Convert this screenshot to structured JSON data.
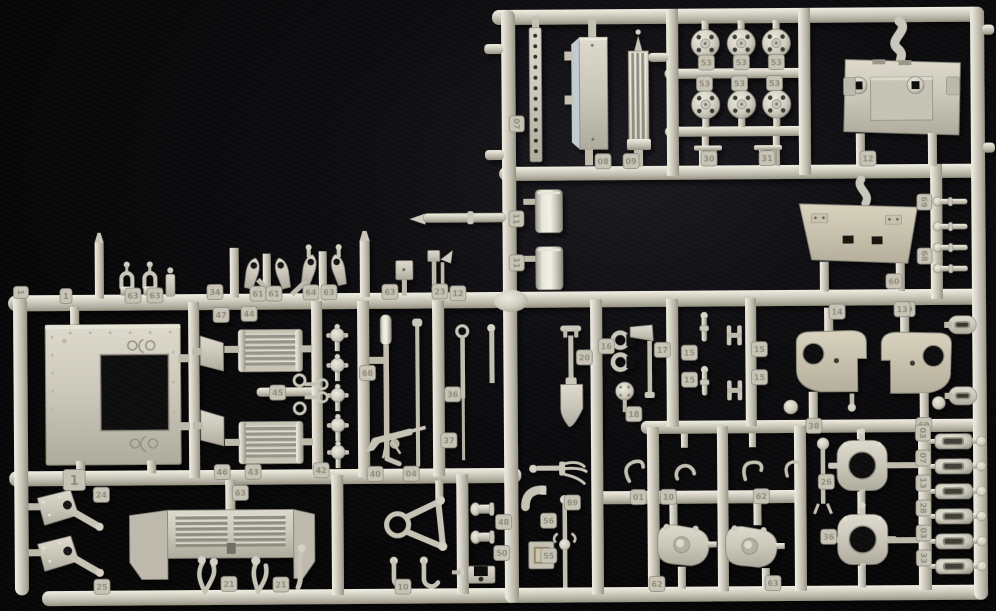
{
  "scene": {
    "description": "Photograph of a light grey injection-moulded plastic model kit sprue (parts tree) for an armoured vehicle kit, lying on a black cloth background",
    "object": "model-kit-sprue",
    "background_color": "#0a0a0c",
    "plastic_color": "#cdcabd",
    "plastic_highlight": "#f1efe4",
    "plastic_shadow": "#8e8c80",
    "tag_plate_color": "#c6c3b5",
    "tag_text_color": "#8f8c7d",
    "tag_edge_color": "#86847a"
  },
  "part_tags": [
    {
      "x": 518,
      "y": 124,
      "label": "07",
      "rot": 90
    },
    {
      "x": 604,
      "y": 162,
      "label": "08"
    },
    {
      "x": 632,
      "y": 162,
      "label": "09"
    },
    {
      "x": 708,
      "y": 64,
      "label": "53"
    },
    {
      "x": 743,
      "y": 64,
      "label": "53"
    },
    {
      "x": 778,
      "y": 64,
      "label": "53"
    },
    {
      "x": 706,
      "y": 85,
      "label": "53"
    },
    {
      "x": 741,
      "y": 85,
      "label": "53"
    },
    {
      "x": 776,
      "y": 85,
      "label": "53"
    },
    {
      "x": 710,
      "y": 160,
      "label": "30"
    },
    {
      "x": 768,
      "y": 160,
      "label": "31"
    },
    {
      "x": 869,
      "y": 161,
      "label": "12"
    },
    {
      "x": 925,
      "y": 205,
      "label": "69",
      "rot": 90
    },
    {
      "x": 925,
      "y": 259,
      "label": "68",
      "rot": 90
    },
    {
      "x": 894,
      "y": 284,
      "label": "60"
    },
    {
      "x": 907,
      "y": 312,
      "label": "19"
    },
    {
      "x": 517,
      "y": 219,
      "label": "11",
      "rot": 90
    },
    {
      "x": 517,
      "y": 263,
      "label": "11",
      "rot": 90
    },
    {
      "x": 440,
      "y": 291,
      "label": "23"
    },
    {
      "x": 458,
      "y": 293,
      "label": "12"
    },
    {
      "x": 21,
      "y": 289,
      "label": "1",
      "rot": 90
    },
    {
      "x": 66,
      "y": 293,
      "label": "1"
    },
    {
      "x": 133,
      "y": 293,
      "label": "63"
    },
    {
      "x": 155,
      "y": 293,
      "label": "63"
    },
    {
      "x": 215,
      "y": 290,
      "label": "34"
    },
    {
      "x": 258,
      "y": 292,
      "label": "61"
    },
    {
      "x": 274,
      "y": 292,
      "label": "61"
    },
    {
      "x": 311,
      "y": 291,
      "label": "64"
    },
    {
      "x": 329,
      "y": 291,
      "label": "63"
    },
    {
      "x": 390,
      "y": 291,
      "label": "63"
    },
    {
      "x": 221,
      "y": 313,
      "label": "47"
    },
    {
      "x": 249,
      "y": 312,
      "label": "44"
    },
    {
      "x": 221,
      "y": 470,
      "label": "46"
    },
    {
      "x": 252,
      "y": 470,
      "label": "43"
    },
    {
      "x": 320,
      "y": 469,
      "label": "42"
    },
    {
      "x": 277,
      "y": 391,
      "label": "45"
    },
    {
      "x": 367,
      "y": 372,
      "label": "68"
    },
    {
      "x": 452,
      "y": 394,
      "label": "36"
    },
    {
      "x": 448,
      "y": 440,
      "label": "37"
    },
    {
      "x": 584,
      "y": 358,
      "label": "20"
    },
    {
      "x": 606,
      "y": 347,
      "label": "16"
    },
    {
      "x": 662,
      "y": 351,
      "label": "17"
    },
    {
      "x": 633,
      "y": 415,
      "label": "18"
    },
    {
      "x": 689,
      "y": 354,
      "label": "15"
    },
    {
      "x": 689,
      "y": 381,
      "label": "15"
    },
    {
      "x": 759,
      "y": 351,
      "label": "15"
    },
    {
      "x": 759,
      "y": 379,
      "label": "15"
    },
    {
      "x": 837,
      "y": 314,
      "label": "14"
    },
    {
      "x": 902,
      "y": 312,
      "label": "13"
    },
    {
      "x": 813,
      "y": 428,
      "label": "38"
    },
    {
      "x": 923,
      "y": 428,
      "label": "60"
    },
    {
      "x": 100,
      "y": 492,
      "label": "24"
    },
    {
      "x": 100,
      "y": 584,
      "label": "25"
    },
    {
      "x": 239,
      "y": 491,
      "label": "63"
    },
    {
      "x": 227,
      "y": 582,
      "label": "21"
    },
    {
      "x": 279,
      "y": 583,
      "label": "21"
    },
    {
      "x": 374,
      "y": 473,
      "label": "40"
    },
    {
      "x": 410,
      "y": 473,
      "label": "04"
    },
    {
      "x": 401,
      "y": 586,
      "label": "10"
    },
    {
      "x": 502,
      "y": 522,
      "label": "48"
    },
    {
      "x": 500,
      "y": 553,
      "label": "50"
    },
    {
      "x": 547,
      "y": 521,
      "label": "56"
    },
    {
      "x": 571,
      "y": 503,
      "label": "89"
    },
    {
      "x": 547,
      "y": 556,
      "label": "55"
    },
    {
      "x": 637,
      "y": 498,
      "label": "01"
    },
    {
      "x": 667,
      "y": 498,
      "label": "10"
    },
    {
      "x": 760,
      "y": 498,
      "label": "62"
    },
    {
      "x": 655,
      "y": 585,
      "label": "62"
    },
    {
      "x": 771,
      "y": 585,
      "label": "63"
    },
    {
      "x": 825,
      "y": 484,
      "label": "26"
    },
    {
      "x": 827,
      "y": 539,
      "label": "36"
    },
    {
      "x": 922,
      "y": 436,
      "label": "03",
      "rot": 90
    },
    {
      "x": 922,
      "y": 461,
      "label": "07",
      "rot": 90
    },
    {
      "x": 922,
      "y": 486,
      "label": "13",
      "rot": 90
    },
    {
      "x": 922,
      "y": 511,
      "label": "28",
      "rot": 90
    },
    {
      "x": 922,
      "y": 536,
      "label": "03",
      "rot": 90
    },
    {
      "x": 922,
      "y": 561,
      "label": "33",
      "rot": 90
    },
    {
      "x": 73,
      "y": 477,
      "label": "1",
      "big": true
    }
  ]
}
